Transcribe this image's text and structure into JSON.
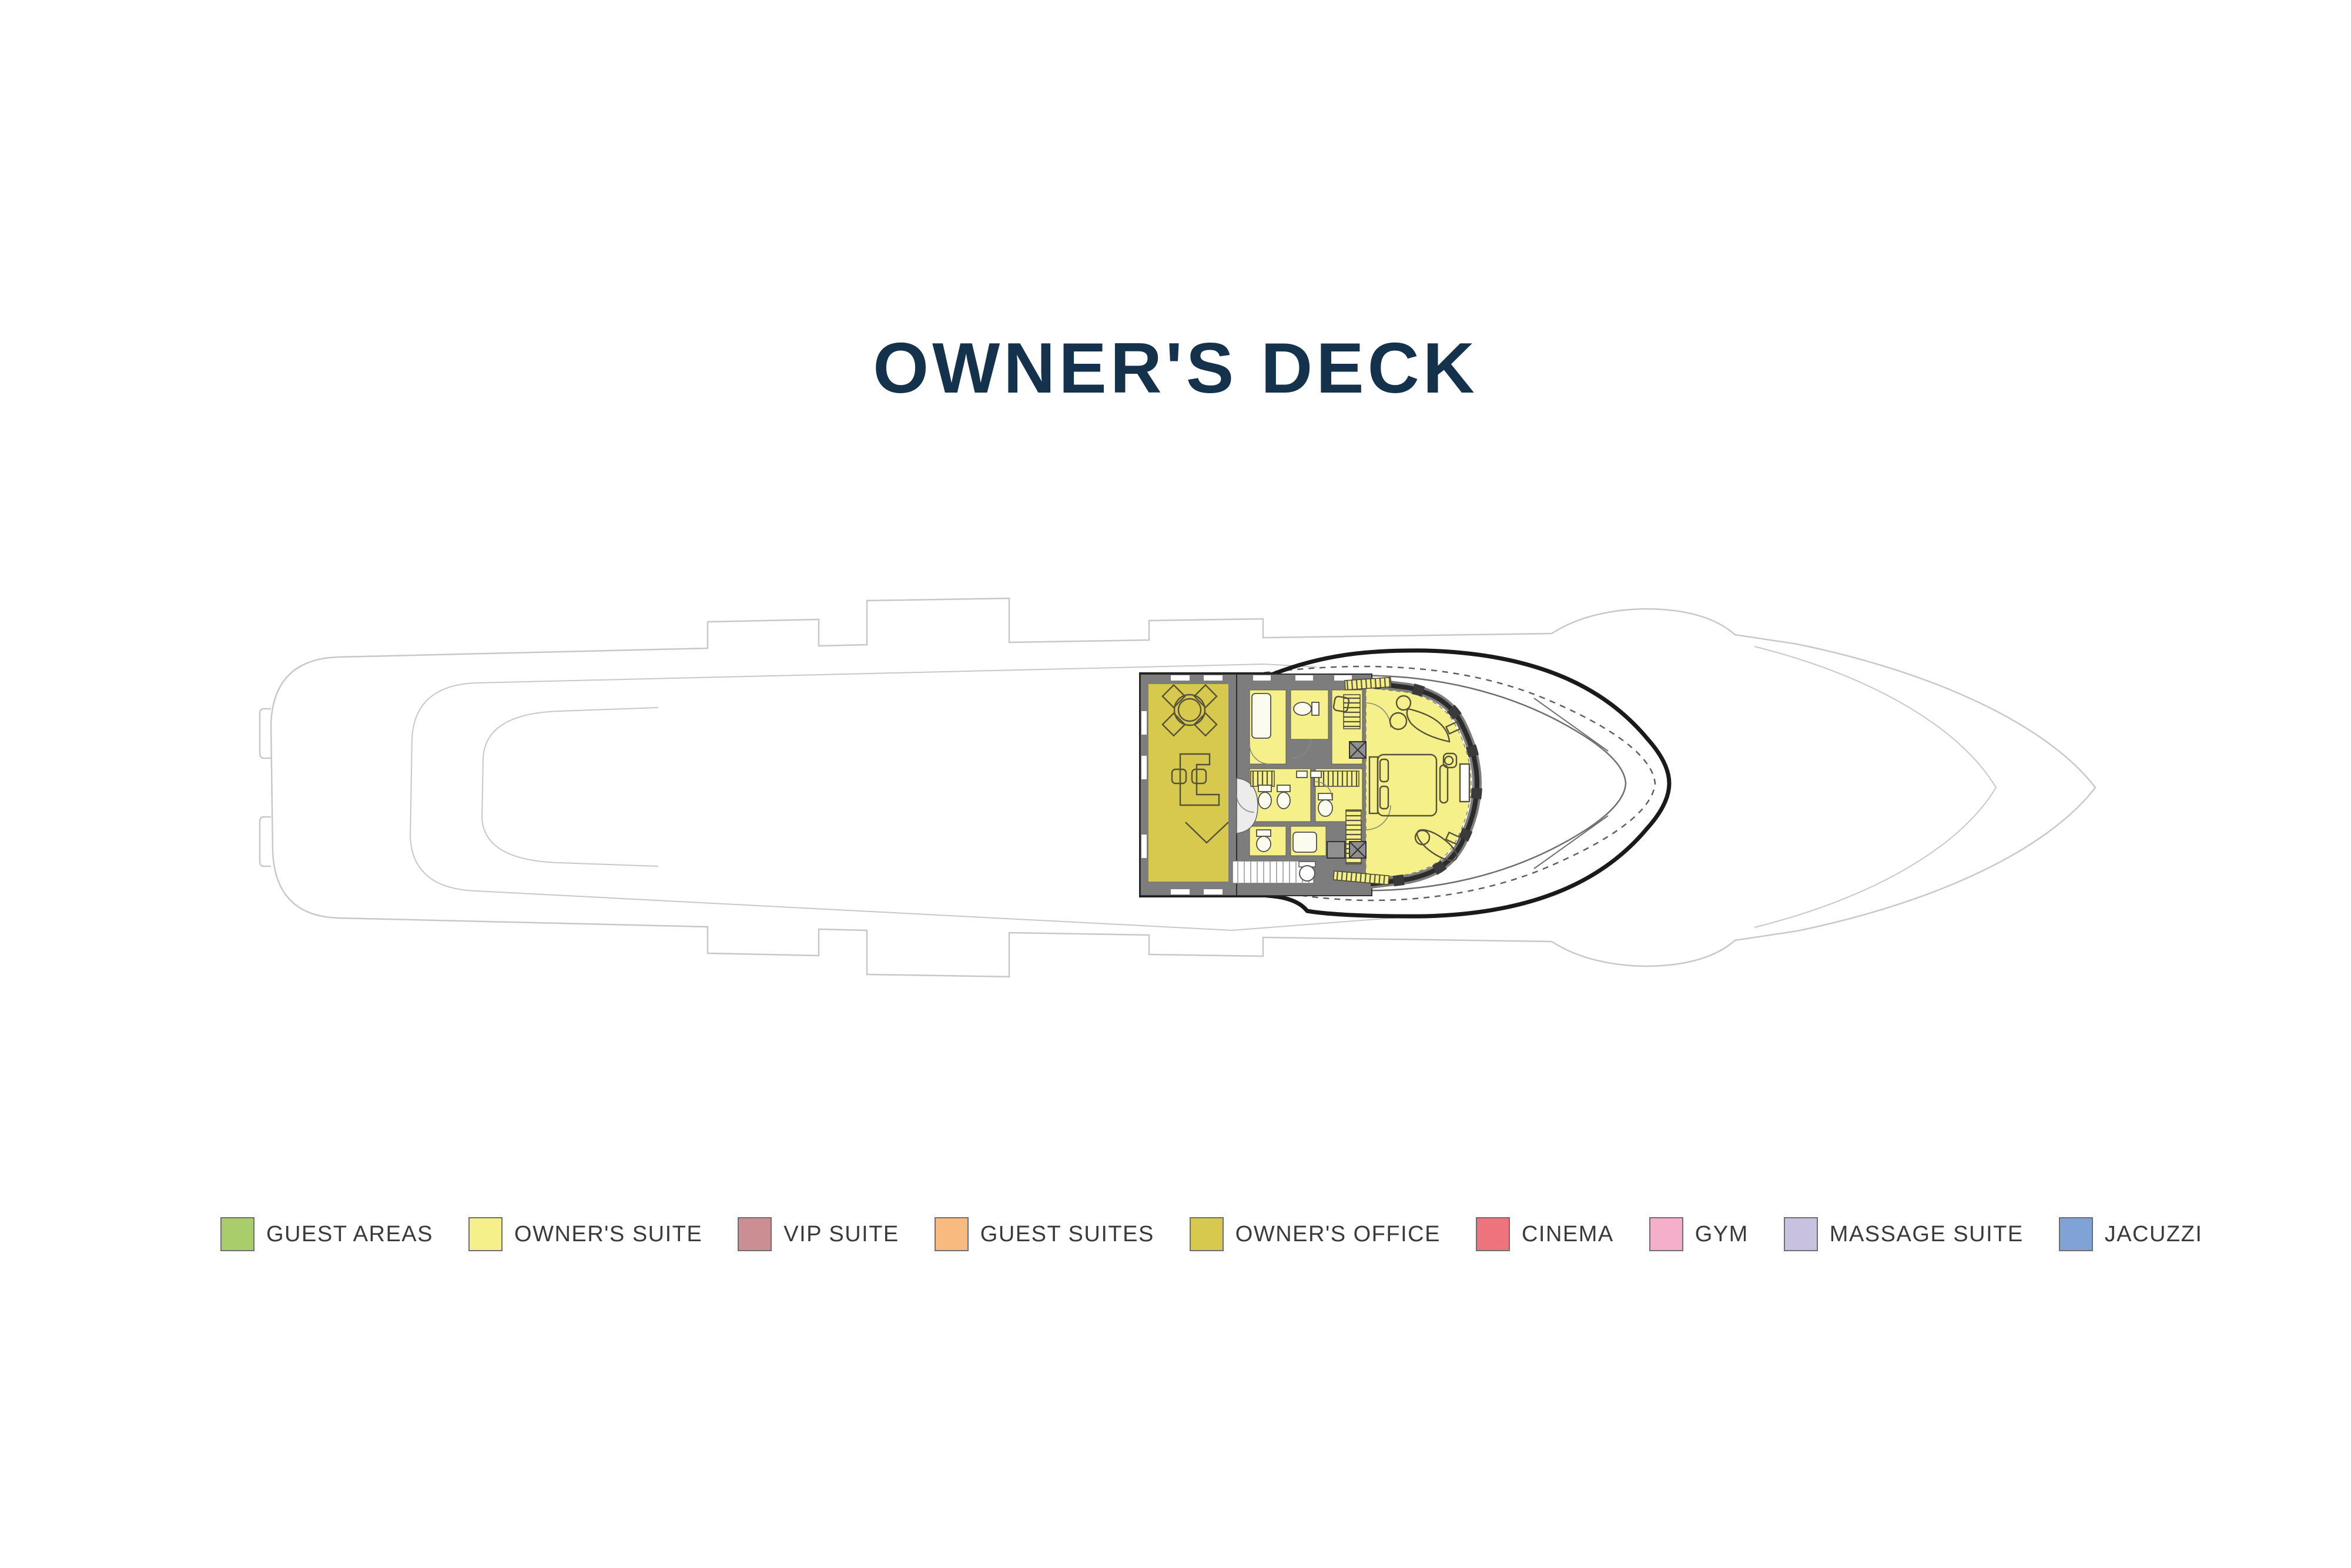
{
  "page": {
    "title": "OWNER'S DECK",
    "title_color": "#14324b",
    "background": "#ffffff"
  },
  "legend": {
    "text_color": "#3a3a3a",
    "swatch_border": "#6f6f6f",
    "colors": {
      "guest_areas": "#a9cd6a",
      "owners_suite": "#f6f08b",
      "vip_suite": "#cb8e92",
      "guest_suites": "#f9ba80",
      "owners_office": "#d7c94e",
      "cinema": "#ef737c",
      "gym": "#f6afcb",
      "massage_suite": "#c8c1e0",
      "jacuzzi": "#7fa3d7"
    },
    "items": [
      {
        "key": "guest_areas",
        "label": "GUEST AREAS"
      },
      {
        "key": "owners_suite",
        "label": "OWNER'S SUITE"
      },
      {
        "key": "vip_suite",
        "label": "VIP SUITE"
      },
      {
        "key": "guest_suites",
        "label": "GUEST SUITES"
      },
      {
        "key": "owners_office",
        "label": "OWNER'S OFFICE"
      },
      {
        "key": "cinema",
        "label": "CINEMA"
      },
      {
        "key": "gym",
        "label": "GYM"
      },
      {
        "key": "massage_suite",
        "label": "MASSAGE SUITE"
      },
      {
        "key": "jacuzzi",
        "label": "JACUZZI"
      }
    ]
  },
  "plan": {
    "hull_line_color": "#c8c8c8",
    "inner_line_color": "#6e6e6e",
    "superstructure_line_color": "#1a1a1a",
    "wall_color": "#7d7d7d",
    "fixture_fill": "#fcfbf0",
    "furniture_line_color": "#55513a"
  }
}
